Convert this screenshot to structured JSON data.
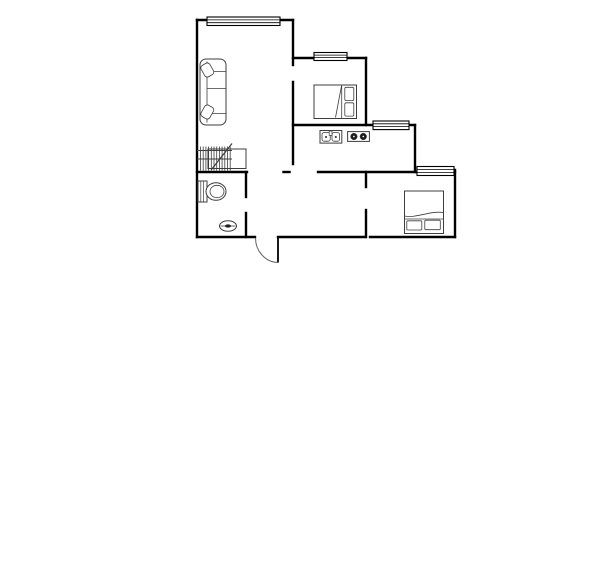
{
  "meta": {
    "image_type": "floor-plan",
    "background_color": "#ffffff",
    "wall_color": "#000000",
    "furniture_color": "#3d3d3d",
    "canvas": {
      "width": 600,
      "height": 584
    }
  },
  "floorplan": {
    "layers": [
      {
        "name": "walls-layer",
        "stroke": "#000000",
        "width": 2.4,
        "linecap": "square",
        "shapes": [
          {
            "t": "line",
            "name": "wall-living-top",
            "x1": 197,
            "y1": 20,
            "x2": 293,
            "y2": 20
          },
          {
            "t": "line",
            "name": "wall-left-exterior",
            "x1": 197,
            "y1": 20,
            "x2": 197,
            "y2": 237
          },
          {
            "t": "line",
            "name": "wall-living-east-upper",
            "x1": 293,
            "y1": 20,
            "x2": 293,
            "y2": 65
          },
          {
            "t": "line",
            "name": "wall-kitchen-west",
            "x1": 293,
            "y1": 82,
            "x2": 293,
            "y2": 164
          },
          {
            "t": "line",
            "name": "wall-bedroom1-top",
            "x1": 293,
            "y1": 58,
            "x2": 366,
            "y2": 58
          },
          {
            "t": "line",
            "name": "wall-bedroom1-east",
            "x1": 366,
            "y1": 58,
            "x2": 366,
            "y2": 125
          },
          {
            "t": "line",
            "name": "wall-dining-north",
            "x1": 293,
            "y1": 125,
            "x2": 415,
            "y2": 125
          },
          {
            "t": "line",
            "name": "wall-step",
            "x1": 415,
            "y1": 125,
            "x2": 415,
            "y2": 172
          },
          {
            "t": "line",
            "name": "wall-hall-north",
            "x1": 318,
            "y1": 172,
            "x2": 455,
            "y2": 172
          },
          {
            "t": "line",
            "name": "wall-hall-stub",
            "x1": 283.5,
            "y1": 172,
            "x2": 289.5,
            "y2": 172
          },
          {
            "t": "line",
            "name": "wall-bathroom-north",
            "x1": 197,
            "y1": 172,
            "x2": 247,
            "y2": 172
          },
          {
            "t": "line",
            "name": "wall-bathroom-east-upper",
            "x1": 246,
            "y1": 172,
            "x2": 246,
            "y2": 197
          },
          {
            "t": "line",
            "name": "wall-bathroom-east-lower",
            "x1": 246,
            "y1": 213,
            "x2": 246,
            "y2": 237
          },
          {
            "t": "line",
            "name": "wall-bedroom2-west-upper",
            "x1": 366,
            "y1": 172,
            "x2": 366,
            "y2": 187
          },
          {
            "t": "line",
            "name": "wall-bedroom2-west-lower",
            "x1": 366,
            "y1": 210,
            "x2": 366,
            "y2": 237
          },
          {
            "t": "line",
            "name": "wall-bedroom2-east",
            "x1": 455,
            "y1": 170,
            "x2": 455,
            "y2": 237
          },
          {
            "t": "line",
            "name": "wall-bottom-bathroom",
            "x1": 197,
            "y1": 237,
            "x2": 255,
            "y2": 237
          },
          {
            "t": "line",
            "name": "wall-bottom-hall",
            "x1": 278,
            "y1": 237,
            "x2": 365,
            "y2": 237
          },
          {
            "t": "line",
            "name": "wall-bottom-bedroom2",
            "x1": 370,
            "y1": 237,
            "x2": 455,
            "y2": 237
          }
        ]
      },
      {
        "name": "windows-layer",
        "stroke": "#000000",
        "width": 1.1,
        "fill": "#ffffff",
        "shapes": [
          {
            "t": "rect",
            "name": "window-living-frame",
            "x": 207,
            "y": 17,
            "w": 73,
            "h": 8.5
          },
          {
            "t": "line",
            "name": "window-pane-line",
            "x1": 207,
            "y1": 19.9,
            "x2": 280,
            "y2": 19.9,
            "sw": 0.8
          },
          {
            "t": "line",
            "name": "window-pane-line",
            "x1": 207,
            "y1": 22.7,
            "x2": 280,
            "y2": 22.7,
            "sw": 0.8
          },
          {
            "t": "rect",
            "name": "window-bedroom1-frame",
            "x": 314,
            "y": 52.5,
            "w": 33,
            "h": 8
          },
          {
            "t": "line",
            "name": "window-pane-line",
            "x1": 314,
            "y1": 55.1,
            "x2": 347,
            "y2": 55.1,
            "sw": 0.8
          },
          {
            "t": "line",
            "name": "window-pane-line",
            "x1": 314,
            "y1": 57.6,
            "x2": 347,
            "y2": 57.6,
            "sw": 0.8
          },
          {
            "t": "rect",
            "name": "window-dining-frame",
            "x": 373,
            "y": 121,
            "w": 36,
            "h": 8.6
          },
          {
            "t": "line",
            "name": "window-pane-line",
            "x1": 373,
            "y1": 123.8,
            "x2": 409,
            "y2": 123.8,
            "sw": 0.8
          },
          {
            "t": "line",
            "name": "window-pane-line",
            "x1": 373,
            "y1": 126.5,
            "x2": 409,
            "y2": 126.5,
            "sw": 0.8
          },
          {
            "t": "rect",
            "name": "window-bedroom2-frame",
            "x": 417,
            "y": 166.5,
            "w": 37,
            "h": 9
          },
          {
            "t": "line",
            "name": "window-pane-line",
            "x1": 417,
            "y1": 169.5,
            "x2": 454,
            "y2": 169.5,
            "sw": 0.8
          },
          {
            "t": "line",
            "name": "window-pane-line",
            "x1": 417,
            "y1": 172.4,
            "x2": 454,
            "y2": 172.4,
            "sw": 0.8
          }
        ]
      },
      {
        "name": "doors-layer",
        "stroke": "#000000",
        "width": 1.8,
        "shapes": [
          {
            "t": "line",
            "name": "entry-door-leaf",
            "x1": 278,
            "y1": 237.5,
            "x2": 278,
            "y2": 262.5
          },
          {
            "t": "path",
            "name": "entry-door-swing-arc",
            "d": "M 255.5 238 A 23 24.5 0 0 0 278 262.5",
            "stroke": "#666666",
            "sw": 1,
            "fill": "none"
          }
        ]
      },
      {
        "name": "furniture-layer",
        "stroke": "#3d3d3d",
        "width": 1,
        "fill": "#ffffff",
        "shapes": [
          {
            "t": "rect",
            "name": "sofa-body",
            "x": 200,
            "y": 59,
            "w": 26,
            "h": 66,
            "rx": 6
          },
          {
            "t": "line",
            "name": "sofa-backrest-line",
            "x1": 207,
            "y1": 61.5,
            "x2": 207,
            "y2": 122.5,
            "sw": 0.8
          },
          {
            "t": "line",
            "name": "sofa-armrest-line",
            "x1": 207,
            "y1": 71.5,
            "x2": 225.5,
            "y2": 71.5,
            "sw": 0.8
          },
          {
            "t": "line",
            "name": "sofa-cushion-divider",
            "x1": 207,
            "y1": 88.5,
            "x2": 225.5,
            "y2": 88.5,
            "sw": 0.8
          },
          {
            "t": "line",
            "name": "sofa-armrest-line",
            "x1": 207,
            "y1": 113.5,
            "x2": 225.5,
            "y2": 113.5,
            "sw": 0.8
          },
          {
            "t": "rect",
            "name": "sofa-pillow",
            "x": 202.3,
            "y": 63.5,
            "w": 10,
            "h": 13,
            "rx": 3,
            "tf": "rotate(-30 207.3 70)",
            "sw": 0.8
          },
          {
            "t": "rect",
            "name": "sofa-pillow",
            "x": 202.3,
            "y": 105.5,
            "w": 10,
            "h": 13,
            "rx": 3,
            "tf": "rotate(30 207.3 112)",
            "sw": 0.8
          },
          {
            "t": "rect",
            "name": "hatch-cabinet-frame",
            "x": 208,
            "y": 149,
            "w": 38,
            "h": 19.5,
            "fill": "none"
          },
          {
            "t": "line",
            "name": "hatch-line",
            "x1": 200.5,
            "y1": 146.5,
            "x2": 200.5,
            "y2": 170.5,
            "sw": 0.8
          },
          {
            "t": "line",
            "name": "hatch-line",
            "x1": 203.2,
            "y1": 146.5,
            "x2": 203.2,
            "y2": 170.5,
            "sw": 0.8
          },
          {
            "t": "line",
            "name": "hatch-line",
            "x1": 205.9,
            "y1": 146.5,
            "x2": 205.9,
            "y2": 170.5,
            "sw": 0.8
          },
          {
            "t": "line",
            "name": "hatch-line",
            "x1": 208.6,
            "y1": 146.5,
            "x2": 208.6,
            "y2": 170.5,
            "sw": 0.8
          },
          {
            "t": "line",
            "name": "hatch-line",
            "x1": 211.3,
            "y1": 146.5,
            "x2": 211.3,
            "y2": 170.5,
            "sw": 0.8
          },
          {
            "t": "line",
            "name": "hatch-line",
            "x1": 214,
            "y1": 146.5,
            "x2": 214,
            "y2": 170.5,
            "sw": 0.8
          },
          {
            "t": "line",
            "name": "hatch-line",
            "x1": 216.7,
            "y1": 146.5,
            "x2": 216.7,
            "y2": 170.5,
            "sw": 0.8
          },
          {
            "t": "line",
            "name": "hatch-line",
            "x1": 219.4,
            "y1": 146.5,
            "x2": 219.4,
            "y2": 170.5,
            "sw": 0.8
          },
          {
            "t": "line",
            "name": "hatch-line",
            "x1": 222.1,
            "y1": 146.5,
            "x2": 222.1,
            "y2": 170.5,
            "sw": 0.8
          },
          {
            "t": "line",
            "name": "hatch-line",
            "x1": 224.8,
            "y1": 146.5,
            "x2": 224.8,
            "y2": 170.5,
            "sw": 0.8
          },
          {
            "t": "line",
            "name": "hatch-line",
            "x1": 227.5,
            "y1": 146.5,
            "x2": 227.5,
            "y2": 170.5,
            "sw": 0.8
          },
          {
            "t": "line",
            "name": "hatch-line",
            "x1": 230.2,
            "y1": 146.5,
            "x2": 230.2,
            "y2": 170.5,
            "sw": 0.8
          },
          {
            "t": "line",
            "name": "hatch-rail",
            "x1": 197,
            "y1": 150.5,
            "x2": 232,
            "y2": 150.5,
            "sw": 0.9
          },
          {
            "t": "line",
            "name": "hatch-rail",
            "x1": 197,
            "y1": 159,
            "x2": 232,
            "y2": 159,
            "sw": 0.9
          },
          {
            "t": "line",
            "name": "hatch-diagonal",
            "x1": 211.5,
            "y1": 169.5,
            "x2": 232,
            "y2": 143.5,
            "sw": 1.2
          },
          {
            "t": "rect",
            "name": "toilet-tank",
            "x": 198,
            "y": 181,
            "w": 9,
            "h": 21
          },
          {
            "t": "line",
            "name": "toilet-tank-line",
            "x1": 200.8,
            "y1": 181.5,
            "x2": 200.8,
            "y2": 201.5,
            "sw": 0.7
          },
          {
            "t": "line",
            "name": "toilet-tank-line",
            "x1": 203.5,
            "y1": 181.5,
            "x2": 203.5,
            "y2": 201.5,
            "sw": 0.7
          },
          {
            "t": "ellipse",
            "name": "toilet-bowl-outer",
            "cx": 216,
            "cy": 191.5,
            "rx": 10,
            "ry": 8.8
          },
          {
            "t": "ellipse",
            "name": "toilet-bowl-inner",
            "cx": 217,
            "cy": 191.5,
            "rx": 7,
            "ry": 6.2,
            "sw": 0.8
          },
          {
            "t": "ellipse",
            "name": "washbasin-oval",
            "cx": 228,
            "cy": 226,
            "rx": 8.5,
            "ry": 5.2
          },
          {
            "t": "line",
            "name": "washbasin-midline",
            "x1": 220.5,
            "y1": 226,
            "x2": 235.5,
            "y2": 226,
            "sw": 0.8
          },
          {
            "t": "ellipse",
            "name": "washbasin-drain",
            "cx": 228,
            "cy": 226,
            "rx": 3,
            "ry": 1.6,
            "fill": "#222222",
            "sw": 0.1
          },
          {
            "t": "rect",
            "name": "bed1-frame",
            "x": 314,
            "y": 85,
            "w": 42.5,
            "h": 33.5
          },
          {
            "t": "line",
            "name": "bed1-pillow-divider",
            "x1": 341.7,
            "y1": 85.5,
            "x2": 341.7,
            "y2": 118,
            "sw": 0.8
          },
          {
            "t": "line",
            "name": "bed1-blanket-fold",
            "x1": 341.5,
            "y1": 86,
            "x2": 335.5,
            "y2": 117.5,
            "sw": 0.8
          },
          {
            "t": "rect",
            "name": "bed1-pillow",
            "x": 344.8,
            "y": 87.3,
            "w": 9,
            "h": 13.3,
            "rx": 1.5,
            "sw": 0.8
          },
          {
            "t": "rect",
            "name": "bed1-pillow",
            "x": 344.8,
            "y": 102.8,
            "w": 9,
            "h": 13.3,
            "rx": 1.5,
            "sw": 0.8
          },
          {
            "t": "rect",
            "name": "bed2-frame",
            "x": 404.5,
            "y": 191,
            "w": 39,
            "h": 42.5
          },
          {
            "t": "line",
            "name": "bed2-pillow-divider",
            "x1": 404.5,
            "y1": 219,
            "x2": 443.5,
            "y2": 219,
            "sw": 0.8
          },
          {
            "t": "path",
            "name": "bed2-blanket-fold",
            "d": "M 404.5 216 C 416 218.5 430 210.5 443.5 212.5",
            "fill": "none",
            "sw": 0.8
          },
          {
            "t": "rect",
            "name": "bed2-pillow",
            "x": 406.8,
            "y": 220.8,
            "w": 15,
            "h": 9.2,
            "rx": 1,
            "sw": 0.8
          },
          {
            "t": "rect",
            "name": "bed2-pillow",
            "x": 424.8,
            "y": 220.2,
            "w": 15.5,
            "h": 9.5,
            "rx": 1,
            "sw": 0.8
          },
          {
            "t": "rect",
            "name": "sink-unit",
            "x": 320,
            "y": 130.5,
            "w": 21.8,
            "h": 12.6
          },
          {
            "t": "rect",
            "name": "sink-basin",
            "x": 322,
            "y": 132.6,
            "w": 8.2,
            "h": 8.6,
            "rx": 2,
            "sw": 0.8
          },
          {
            "t": "rect",
            "name": "sink-basin",
            "x": 332,
            "y": 132.6,
            "w": 7.6,
            "h": 8.6,
            "rx": 2,
            "sw": 0.8
          },
          {
            "t": "circle",
            "name": "sink-drain",
            "cx": 326,
            "cy": 137,
            "r": 1,
            "fill": "#333333",
            "sw": 0.1
          },
          {
            "t": "circle",
            "name": "sink-drain",
            "cx": 335.8,
            "cy": 137,
            "r": 1,
            "fill": "#333333",
            "sw": 0.1
          },
          {
            "t": "rect",
            "name": "sink-faucet",
            "x": 329.2,
            "y": 131,
            "w": 2.8,
            "h": 4.4,
            "sw": 0.7
          },
          {
            "t": "rect",
            "name": "stove-unit",
            "x": 347.6,
            "y": 131.6,
            "w": 21.8,
            "h": 9.8
          },
          {
            "t": "circle",
            "name": "stove-burner",
            "cx": 353.9,
            "cy": 136.5,
            "r": 3.3,
            "fill": "#1c1c1c",
            "sw": 0.5
          },
          {
            "t": "circle",
            "name": "stove-burner",
            "cx": 363.3,
            "cy": 136.5,
            "r": 3.3,
            "fill": "#1c1c1c",
            "sw": 0.5
          },
          {
            "t": "circle",
            "name": "stove-burner-center",
            "cx": 353.9,
            "cy": 136.5,
            "r": 0.9,
            "fill": "#ffffff",
            "sw": 0.1
          },
          {
            "t": "circle",
            "name": "stove-burner-center",
            "cx": 363.3,
            "cy": 136.5,
            "r": 0.9,
            "fill": "#ffffff",
            "sw": 0.1
          }
        ]
      }
    ]
  }
}
